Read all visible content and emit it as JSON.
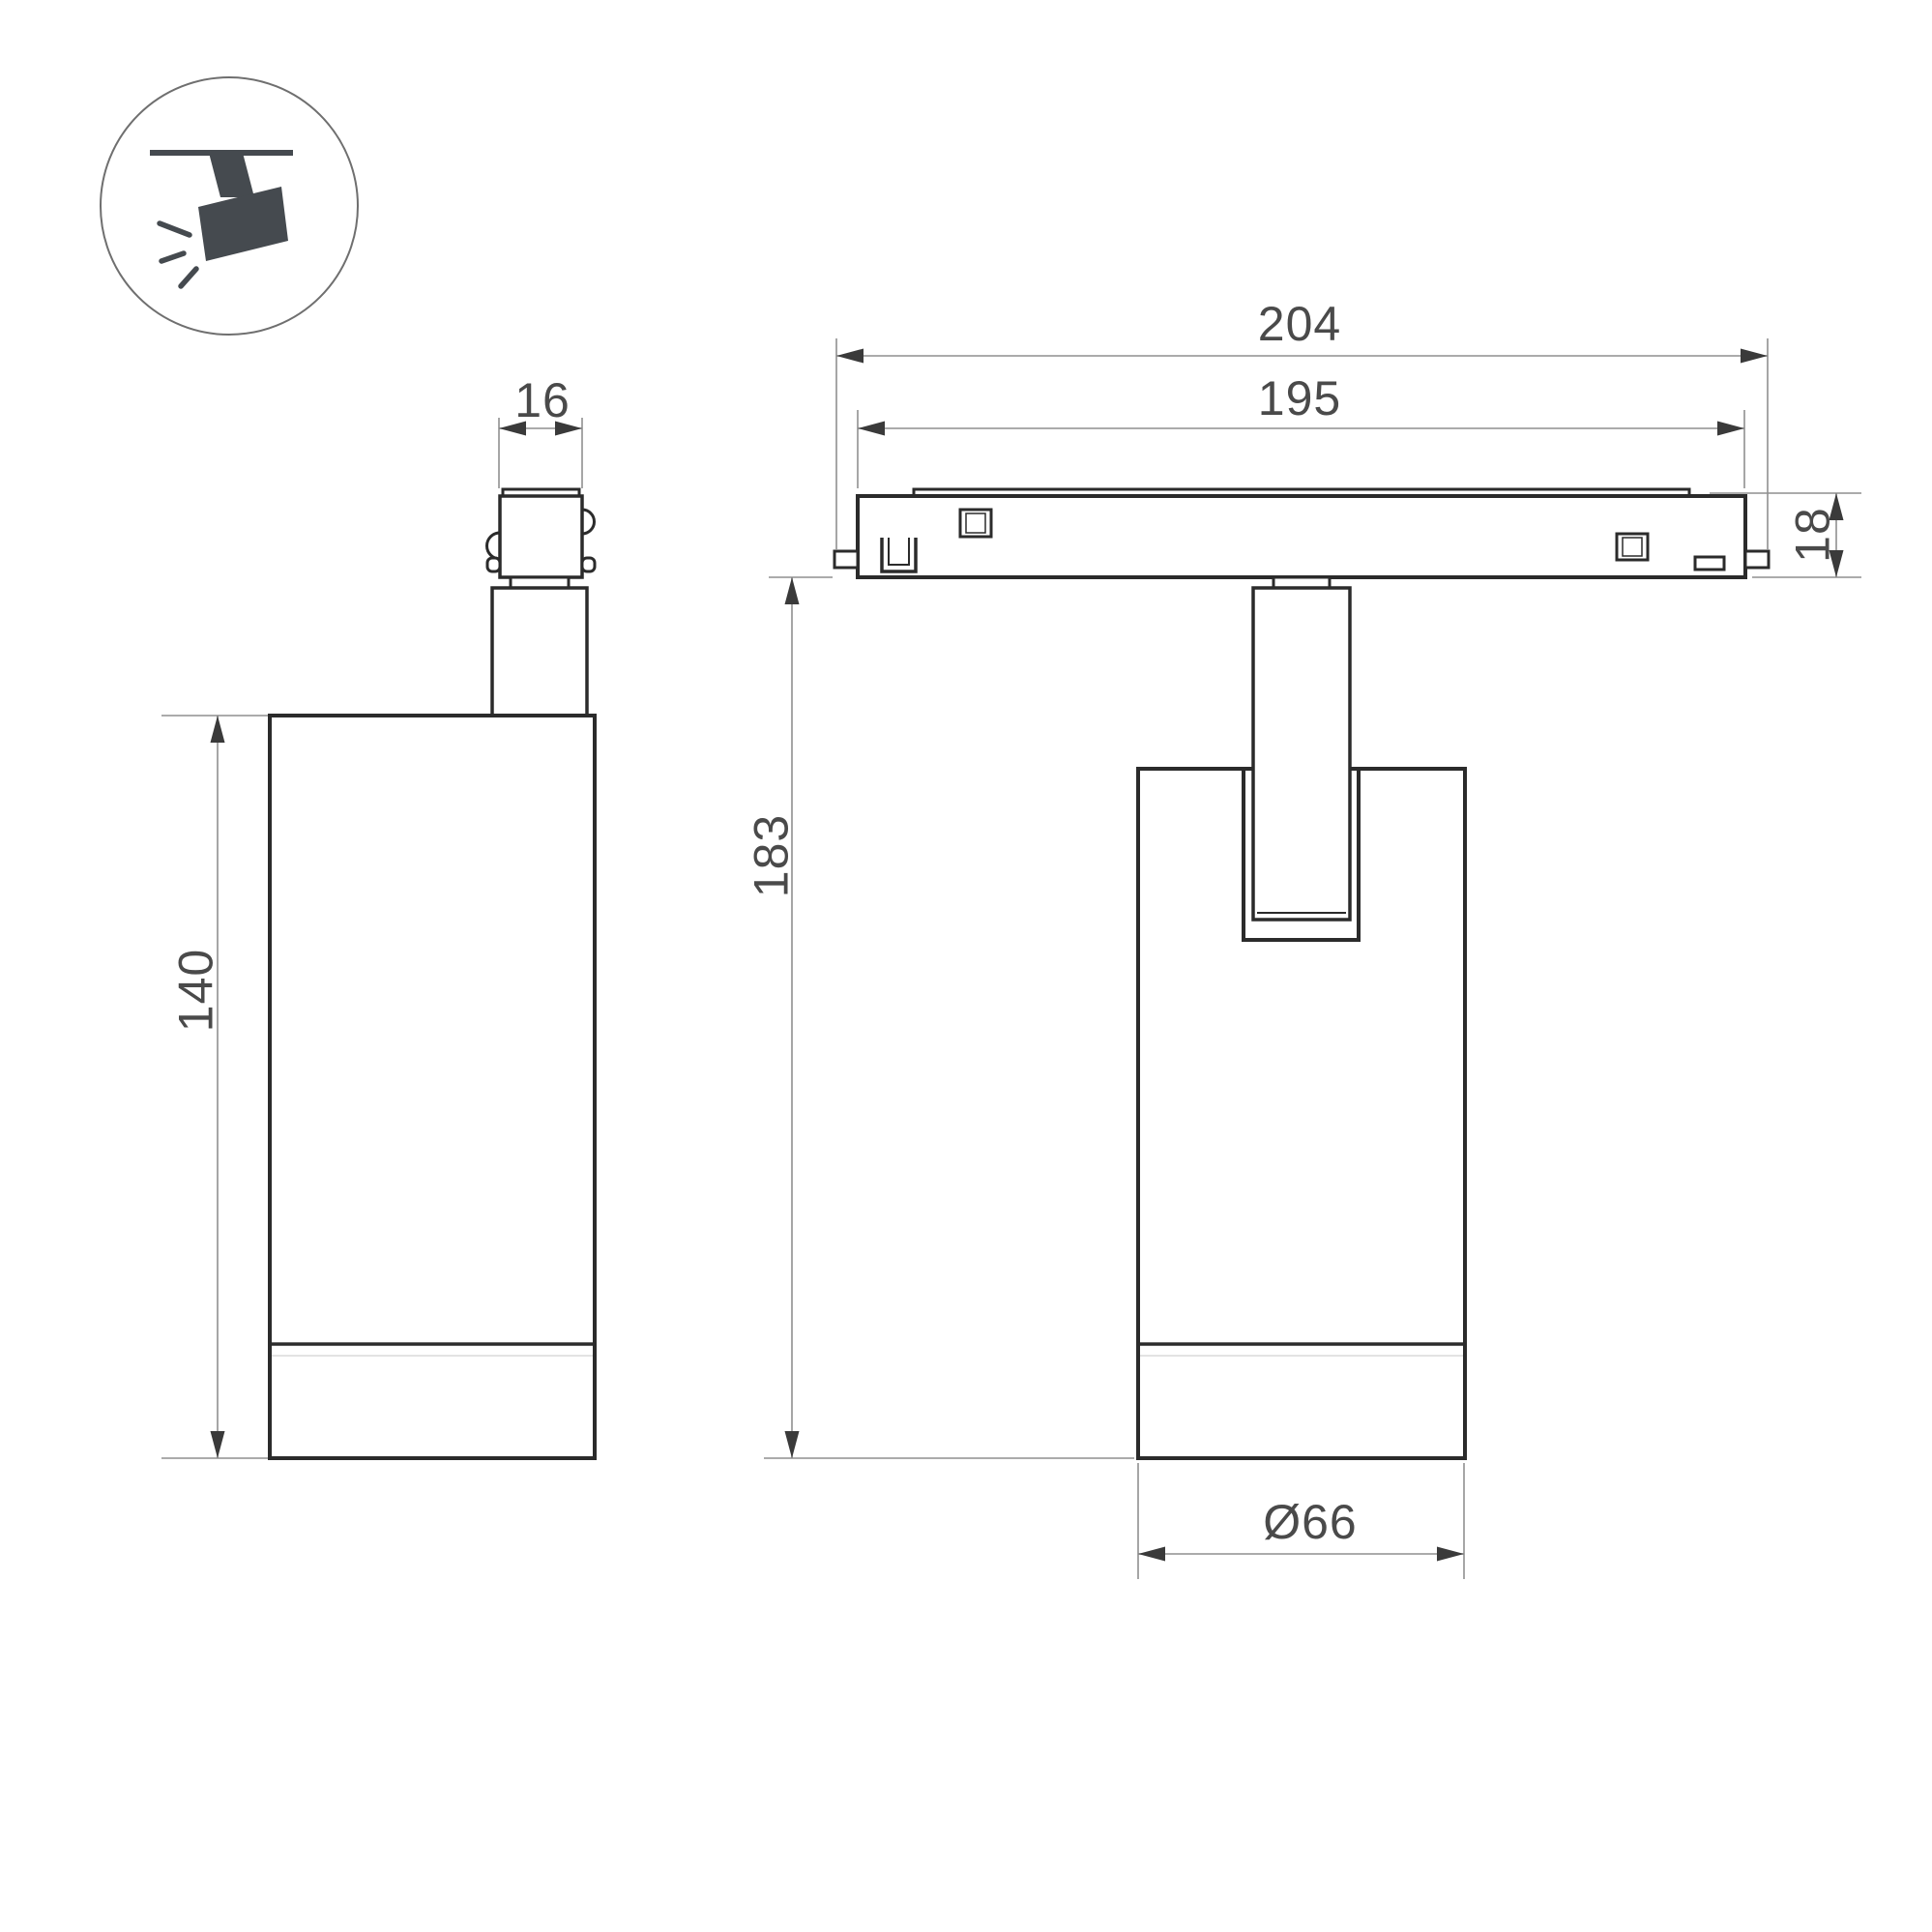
{
  "icon": {
    "name": "ceiling-track-spotlight-icon"
  },
  "dimensions": {
    "adapter_width": "16",
    "track_length_outer": "204",
    "track_length_inner": "195",
    "track_height": "18",
    "body_height": "140",
    "overall_height": "183",
    "body_diameter": "Ø66"
  },
  "colors": {
    "object_line": "#2b2b2b",
    "dimension_line": "#8f8f8f",
    "dimension_text": "#4a4a4a",
    "icon_fill": "#454a4f",
    "background": "#ffffff"
  }
}
